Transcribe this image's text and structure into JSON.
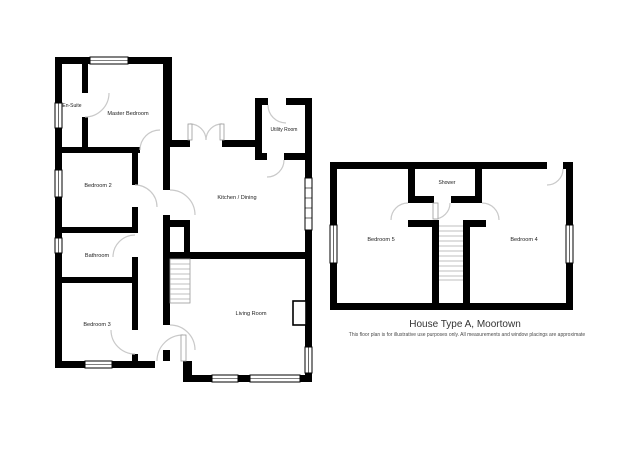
{
  "floorplan": {
    "title": "House Type A, Moortown",
    "disclaimer": "This floor plan is for illustrative use purposes only. All measurements and window placings are approximate",
    "colors": {
      "wall": "#000000",
      "door_arc": "#c9c9c9",
      "window_fill": "#ffffff",
      "label_text": "#222222",
      "title_text": "#333333",
      "background": "#ffffff"
    },
    "rooms": {
      "en_suite": "En-Suite",
      "master_bedroom": "Master Bedroom",
      "bedroom_2": "Bedroom 2",
      "bathroom": "Bathroom",
      "bedroom_3": "Bedroom 3",
      "kitchen_dining": "Kitchen / Dining",
      "utility_room": "Utility Room",
      "living_room": "Living Room",
      "shower": "Shower",
      "bedroom_5": "Bedroom 5",
      "bedroom_4": "Bedroom 4"
    }
  }
}
